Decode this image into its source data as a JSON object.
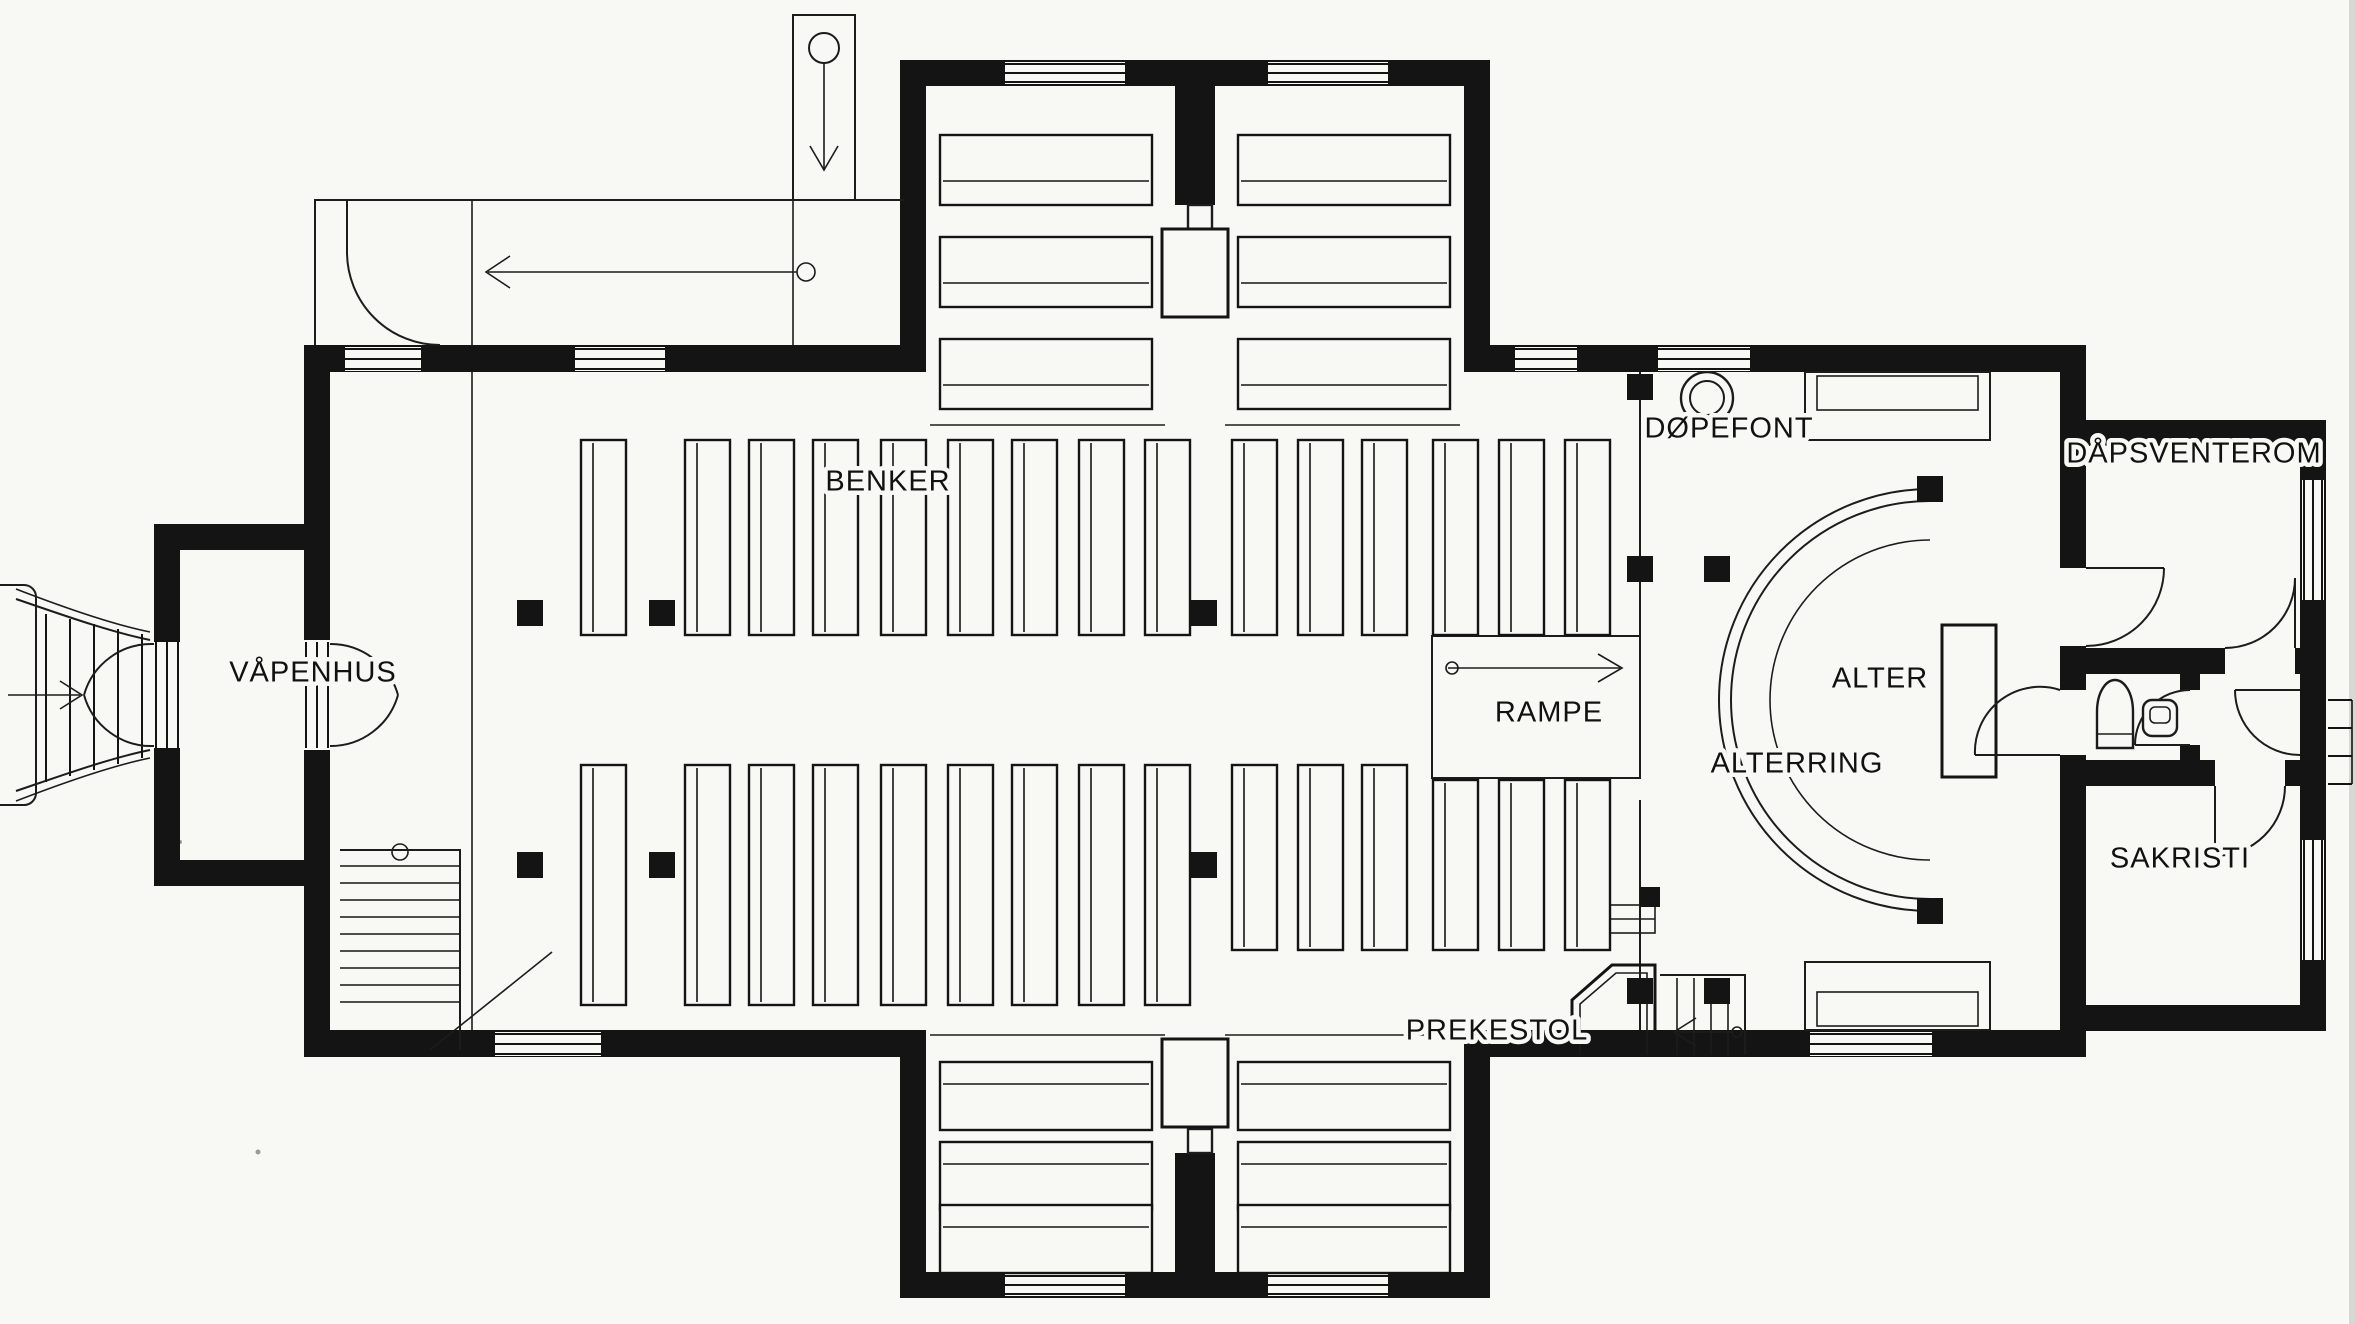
{
  "title": "Church floor plan (scanned architectural drawing)",
  "labels": {
    "vapenhus": "VÅPENHUS",
    "benker": "BENKER",
    "dopefont": "DØPEFONT",
    "dapsventerom": "DÅPSVENTEROM",
    "alter": "ALTER",
    "alterring": "ALTERRING",
    "rampe": "RAMPE",
    "sakristi": "SAKRISTI",
    "prekestol": "PREKESTOL"
  },
  "colors": {
    "paper": "#f8f8f5",
    "ink": "#141414"
  },
  "plan": {
    "canvas": {
      "w": 2355,
      "h": 1324
    },
    "nave_pews": {
      "x_positions": [
        581,
        685,
        749,
        813,
        881,
        948,
        1012,
        1079,
        1145,
        1232,
        1298,
        1362,
        1433,
        1499,
        1565
      ],
      "width": 45,
      "back_line_offset": 12,
      "upper_block": {
        "y": 440,
        "h": 195
      },
      "lower_blocks": [
        {
          "from": 0,
          "to": 8,
          "y": 765,
          "h": 240
        },
        {
          "from": 9,
          "to": 11,
          "y": 765,
          "h": 185
        },
        {
          "from": 12,
          "to": 14,
          "y": 780,
          "h": 170
        }
      ]
    },
    "transept_pews": {
      "group_x": [
        940,
        1238
      ],
      "group_w": 212,
      "top_rows": {
        "ys": [
          135,
          237,
          339
        ],
        "h": 70,
        "seat_offset": 46
      },
      "bottom_rows": {
        "ys": [
          1062,
          1142,
          1205
        ],
        "h": 68,
        "seat_offset": 22
      }
    },
    "pillars": {
      "size": 26,
      "positions": [
        [
          517,
          600
        ],
        [
          649,
          600
        ],
        [
          1191,
          600
        ],
        [
          517,
          852
        ],
        [
          649,
          852
        ],
        [
          1191,
          852
        ],
        [
          1627,
          374
        ],
        [
          1627,
          556
        ],
        [
          1704,
          556
        ],
        [
          1627,
          978
        ],
        [
          1704,
          978
        ],
        [
          1917,
          476
        ],
        [
          1917,
          898
        ]
      ]
    },
    "windows": [
      [
        1005,
        62,
        120,
        22,
        "h"
      ],
      [
        1268,
        62,
        120,
        22,
        "h"
      ],
      [
        345,
        347,
        76,
        24,
        "h"
      ],
      [
        575,
        347,
        90,
        24,
        "h"
      ],
      [
        1515,
        347,
        62,
        24,
        "h"
      ],
      [
        1658,
        347,
        92,
        24,
        "h"
      ],
      [
        495,
        1032,
        106,
        24,
        "h"
      ],
      [
        1810,
        1032,
        122,
        24,
        "h"
      ],
      [
        1005,
        1274,
        120,
        22,
        "h"
      ],
      [
        1268,
        1274,
        120,
        22,
        "h"
      ],
      [
        2302,
        480,
        22,
        120,
        "v"
      ],
      [
        2302,
        840,
        22,
        120,
        "v"
      ],
      [
        154,
        642,
        26,
        106,
        "v"
      ],
      [
        304,
        642,
        26,
        106,
        "v"
      ]
    ],
    "east_steps": {
      "x1": 2328,
      "x2": 2352,
      "ys": [
        700,
        728,
        756,
        784
      ]
    },
    "west_steps": {
      "xs": [
        46,
        70,
        94,
        118,
        142
      ],
      "y_top": [
        614,
        619,
        624,
        629,
        634
      ],
      "y_bot": [
        782,
        776,
        770,
        764,
        758
      ]
    },
    "sw_stairs": {
      "x": 340,
      "w": 120,
      "y_top": 850,
      "tread_ys": [
        866,
        883,
        900,
        917,
        934,
        951,
        968,
        985,
        1002
      ]
    },
    "label_font_px": 29
  }
}
